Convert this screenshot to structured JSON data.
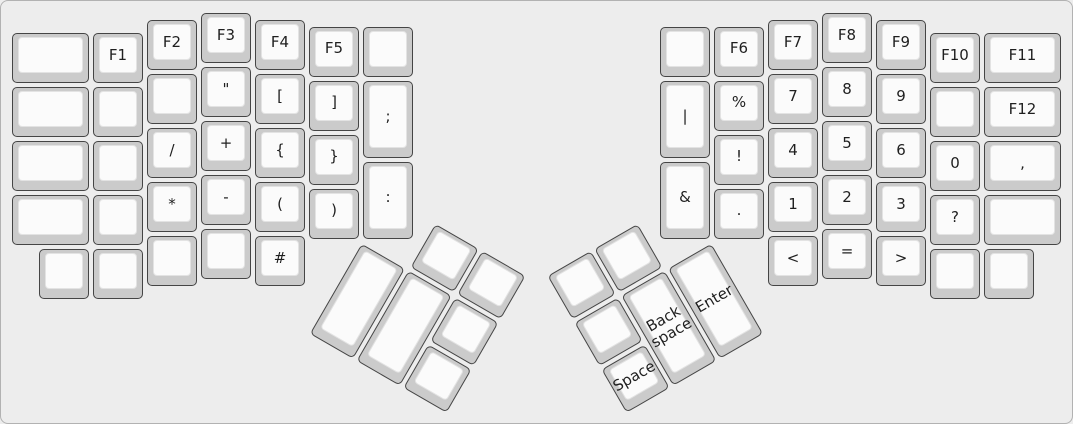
{
  "keyboard": {
    "description": "ErgoDox split keyboard layout, function-symbol layer",
    "unit_px": 54,
    "origin": {
      "x": 10,
      "y": 11
    },
    "colors": {
      "canvas_bg": "#ededed",
      "canvas_border": "#b2b2b2",
      "cap_base": "#cbcbcb",
      "cap_border": "#454545",
      "cap_top": "#fbfbfb",
      "cap_top_border": "#e3e3e3",
      "label": "#1f1f1f"
    },
    "left_main": {
      "keys": [
        {
          "x": 0,
          "y": 0.375,
          "w": 1.5,
          "h": 1,
          "label": ""
        },
        {
          "x": 1.5,
          "y": 0.375,
          "w": 1,
          "h": 1,
          "label": "F1"
        },
        {
          "x": 2.5,
          "y": 0.125,
          "w": 1,
          "h": 1,
          "label": "F2"
        },
        {
          "x": 3.5,
          "y": 0,
          "w": 1,
          "h": 1,
          "label": "F3"
        },
        {
          "x": 4.5,
          "y": 0.125,
          "w": 1,
          "h": 1,
          "label": "F4"
        },
        {
          "x": 5.5,
          "y": 0.25,
          "w": 1,
          "h": 1,
          "label": "F5"
        },
        {
          "x": 6.5,
          "y": 0.25,
          "w": 1,
          "h": 1,
          "label": ""
        },
        {
          "x": 0,
          "y": 1.375,
          "w": 1.5,
          "h": 1,
          "label": ""
        },
        {
          "x": 1.5,
          "y": 1.375,
          "w": 1,
          "h": 1,
          "label": ""
        },
        {
          "x": 2.5,
          "y": 1.125,
          "w": 1,
          "h": 1,
          "label": ""
        },
        {
          "x": 3.5,
          "y": 1,
          "w": 1,
          "h": 1,
          "label": "\""
        },
        {
          "x": 4.5,
          "y": 1.125,
          "w": 1,
          "h": 1,
          "label": "["
        },
        {
          "x": 5.5,
          "y": 1.25,
          "w": 1,
          "h": 1,
          "label": "]"
        },
        {
          "x": 6.5,
          "y": 1.25,
          "w": 1,
          "h": 1.5,
          "label": ";"
        },
        {
          "x": 0,
          "y": 2.375,
          "w": 1.5,
          "h": 1,
          "label": ""
        },
        {
          "x": 1.5,
          "y": 2.375,
          "w": 1,
          "h": 1,
          "label": ""
        },
        {
          "x": 2.5,
          "y": 2.125,
          "w": 1,
          "h": 1,
          "label": "/"
        },
        {
          "x": 3.5,
          "y": 2,
          "w": 1,
          "h": 1,
          "label": "+"
        },
        {
          "x": 4.5,
          "y": 2.125,
          "w": 1,
          "h": 1,
          "label": "{"
        },
        {
          "x": 5.5,
          "y": 2.25,
          "w": 1,
          "h": 1,
          "label": "}"
        },
        {
          "x": 6.5,
          "y": 2.75,
          "w": 1,
          "h": 1.5,
          "label": ":"
        },
        {
          "x": 0,
          "y": 3.375,
          "w": 1.5,
          "h": 1,
          "label": ""
        },
        {
          "x": 1.5,
          "y": 3.375,
          "w": 1,
          "h": 1,
          "label": ""
        },
        {
          "x": 2.5,
          "y": 3.125,
          "w": 1,
          "h": 1,
          "label": "*"
        },
        {
          "x": 3.5,
          "y": 3,
          "w": 1,
          "h": 1,
          "label": "-"
        },
        {
          "x": 4.5,
          "y": 3.125,
          "w": 1,
          "h": 1,
          "label": "("
        },
        {
          "x": 5.5,
          "y": 3.25,
          "w": 1,
          "h": 1,
          "label": ")"
        },
        {
          "x": 0.5,
          "y": 4.375,
          "w": 1,
          "h": 1,
          "label": ""
        },
        {
          "x": 1.5,
          "y": 4.375,
          "w": 1,
          "h": 1,
          "label": ""
        },
        {
          "x": 2.5,
          "y": 4.125,
          "w": 1,
          "h": 1,
          "label": ""
        },
        {
          "x": 3.5,
          "y": 4,
          "w": 1,
          "h": 1,
          "label": ""
        },
        {
          "x": 4.5,
          "y": 4.125,
          "w": 1,
          "h": 1,
          "label": "#"
        }
      ]
    },
    "right_main": {
      "keys": [
        {
          "x": 12,
          "y": 0.25,
          "w": 1,
          "h": 1,
          "label": ""
        },
        {
          "x": 13,
          "y": 0.25,
          "w": 1,
          "h": 1,
          "label": "F6"
        },
        {
          "x": 14,
          "y": 0.125,
          "w": 1,
          "h": 1,
          "label": "F7"
        },
        {
          "x": 15,
          "y": 0,
          "w": 1,
          "h": 1,
          "label": "F8"
        },
        {
          "x": 16,
          "y": 0.125,
          "w": 1,
          "h": 1,
          "label": "F9"
        },
        {
          "x": 17,
          "y": 0.375,
          "w": 1,
          "h": 1,
          "label": "F10"
        },
        {
          "x": 18,
          "y": 0.375,
          "w": 1.5,
          "h": 1,
          "label": "F11"
        },
        {
          "x": 12,
          "y": 1.25,
          "w": 1,
          "h": 1.5,
          "label": "|"
        },
        {
          "x": 13,
          "y": 1.25,
          "w": 1,
          "h": 1,
          "label": "%"
        },
        {
          "x": 14,
          "y": 1.125,
          "w": 1,
          "h": 1,
          "label": "7"
        },
        {
          "x": 15,
          "y": 1,
          "w": 1,
          "h": 1,
          "label": "8"
        },
        {
          "x": 16,
          "y": 1.125,
          "w": 1,
          "h": 1,
          "label": "9"
        },
        {
          "x": 17,
          "y": 1.375,
          "w": 1,
          "h": 1,
          "label": ""
        },
        {
          "x": 18,
          "y": 1.375,
          "w": 1.5,
          "h": 1,
          "label": "F12"
        },
        {
          "x": 12,
          "y": 2.75,
          "w": 1,
          "h": 1.5,
          "label": "&"
        },
        {
          "x": 13,
          "y": 2.25,
          "w": 1,
          "h": 1,
          "label": "!"
        },
        {
          "x": 14,
          "y": 2.125,
          "w": 1,
          "h": 1,
          "label": "4"
        },
        {
          "x": 15,
          "y": 2,
          "w": 1,
          "h": 1,
          "label": "5"
        },
        {
          "x": 16,
          "y": 2.125,
          "w": 1,
          "h": 1,
          "label": "6"
        },
        {
          "x": 17,
          "y": 2.375,
          "w": 1,
          "h": 1,
          "label": "0"
        },
        {
          "x": 18,
          "y": 2.375,
          "w": 1.5,
          "h": 1,
          "label": ","
        },
        {
          "x": 13,
          "y": 3.25,
          "w": 1,
          "h": 1,
          "label": "."
        },
        {
          "x": 14,
          "y": 3.125,
          "w": 1,
          "h": 1,
          "label": "1"
        },
        {
          "x": 15,
          "y": 3,
          "w": 1,
          "h": 1,
          "label": "2"
        },
        {
          "x": 16,
          "y": 3.125,
          "w": 1,
          "h": 1,
          "label": "3"
        },
        {
          "x": 17,
          "y": 3.375,
          "w": 1,
          "h": 1,
          "label": "?"
        },
        {
          "x": 18,
          "y": 3.375,
          "w": 1.5,
          "h": 1,
          "label": ""
        },
        {
          "x": 14,
          "y": 4.125,
          "w": 1,
          "h": 1,
          "label": "<"
        },
        {
          "x": 15,
          "y": 4,
          "w": 1,
          "h": 1,
          "label": "="
        },
        {
          "x": 16,
          "y": 4.125,
          "w": 1,
          "h": 1,
          "label": ">"
        },
        {
          "x": 17,
          "y": 4.375,
          "w": 1,
          "h": 1,
          "label": ""
        },
        {
          "x": 18,
          "y": 4.375,
          "w": 1,
          "h": 1,
          "label": ""
        }
      ]
    },
    "left_thumb": {
      "rotation_deg": 30,
      "center": {
        "x": 6.5,
        "y": 4.25
      },
      "keys": [
        {
          "x": 1,
          "y": -1,
          "w": 1,
          "h": 1,
          "label": ""
        },
        {
          "x": 2,
          "y": -1,
          "w": 1,
          "h": 1,
          "label": ""
        },
        {
          "x": 0,
          "y": 0,
          "w": 1,
          "h": 2,
          "label": ""
        },
        {
          "x": 1,
          "y": 0,
          "w": 1,
          "h": 2,
          "label": ""
        },
        {
          "x": 2,
          "y": 0,
          "w": 1,
          "h": 1,
          "label": ""
        },
        {
          "x": 2,
          "y": 1,
          "w": 1,
          "h": 1,
          "label": ""
        }
      ]
    },
    "right_thumb": {
      "rotation_deg": -30,
      "center": {
        "x": 13,
        "y": 4.25
      },
      "keys": [
        {
          "x": -3,
          "y": -1,
          "w": 1,
          "h": 1,
          "label": ""
        },
        {
          "x": -2,
          "y": -1,
          "w": 1,
          "h": 1,
          "label": ""
        },
        {
          "x": -3,
          "y": 0,
          "w": 1,
          "h": 1,
          "label": ""
        },
        {
          "x": -2,
          "y": 0,
          "w": 1,
          "h": 2,
          "label": "Back space"
        },
        {
          "x": -1,
          "y": 0,
          "w": 1,
          "h": 2,
          "label": "Enter"
        },
        {
          "x": -3,
          "y": 1,
          "w": 1,
          "h": 1,
          "label": "Space"
        }
      ]
    }
  }
}
